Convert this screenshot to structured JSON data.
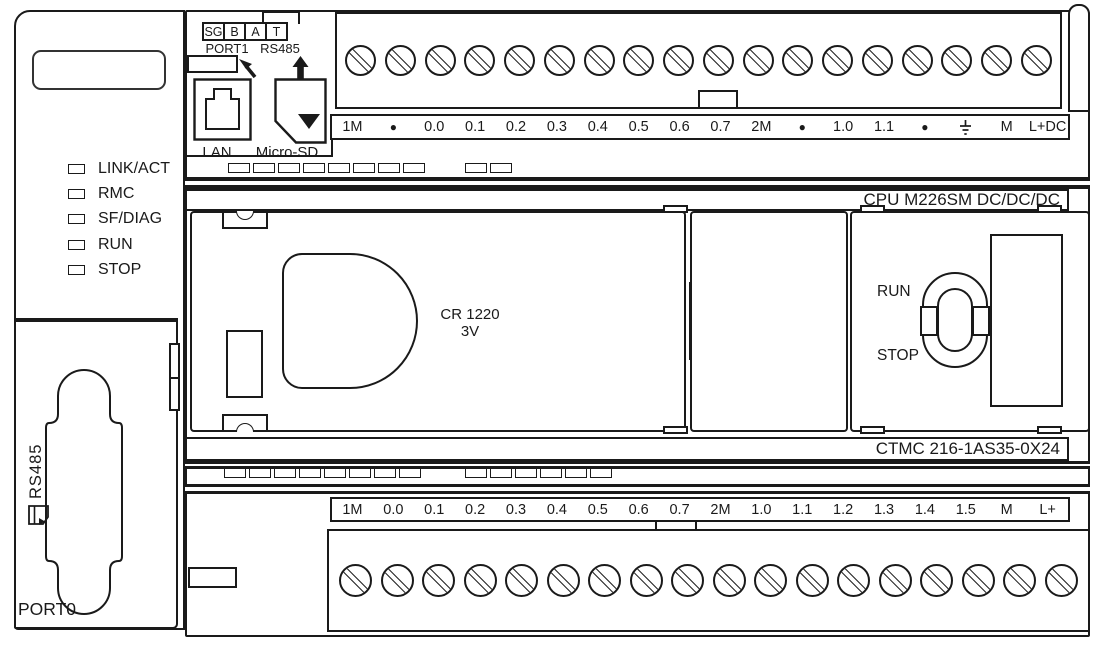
{
  "device": {
    "cpu_label": "CPU M226SM DC/DC/DC",
    "module_label": "CTMC 216-1AS35-0X24",
    "battery": {
      "line1": "CR 1220",
      "line2": "3V"
    },
    "switch": {
      "top": "RUN",
      "bottom": "STOP"
    }
  },
  "leds": [
    "LINK/ACT",
    "RMC",
    "SF/DIAG",
    "RUN",
    "STOP"
  ],
  "ports": {
    "port1_pins": [
      "SG",
      "B",
      "A",
      "T"
    ],
    "port1_label": "PORT1",
    "port1_bus": "RS485",
    "lan_label": "LAN",
    "microsd_label": "Micro-SD",
    "port0_label": "PORT0",
    "port0_bus": "RS485"
  },
  "terminals": {
    "top": [
      "1M",
      "●",
      "0.0",
      "0.1",
      "0.2",
      "0.3",
      "0.4",
      "0.5",
      "0.6",
      "0.7",
      "2M",
      "●",
      "1.0",
      "1.1",
      "●",
      "GND",
      "M",
      "L+DC"
    ],
    "bottom": [
      "1M",
      "0.0",
      "0.1",
      "0.2",
      "0.3",
      "0.4",
      "0.5",
      "0.6",
      "0.7",
      "2M",
      "1.0",
      "1.1",
      "1.2",
      "1.3",
      "1.4",
      "1.5",
      "M",
      "L+"
    ]
  },
  "counts": {
    "top_screws": 18,
    "bottom_screws": 18
  },
  "vents": {
    "row1": [
      8,
      2
    ],
    "row2": [
      8,
      6
    ]
  },
  "colors": {
    "line": "#1a1a1a",
    "background": "#ffffff"
  }
}
